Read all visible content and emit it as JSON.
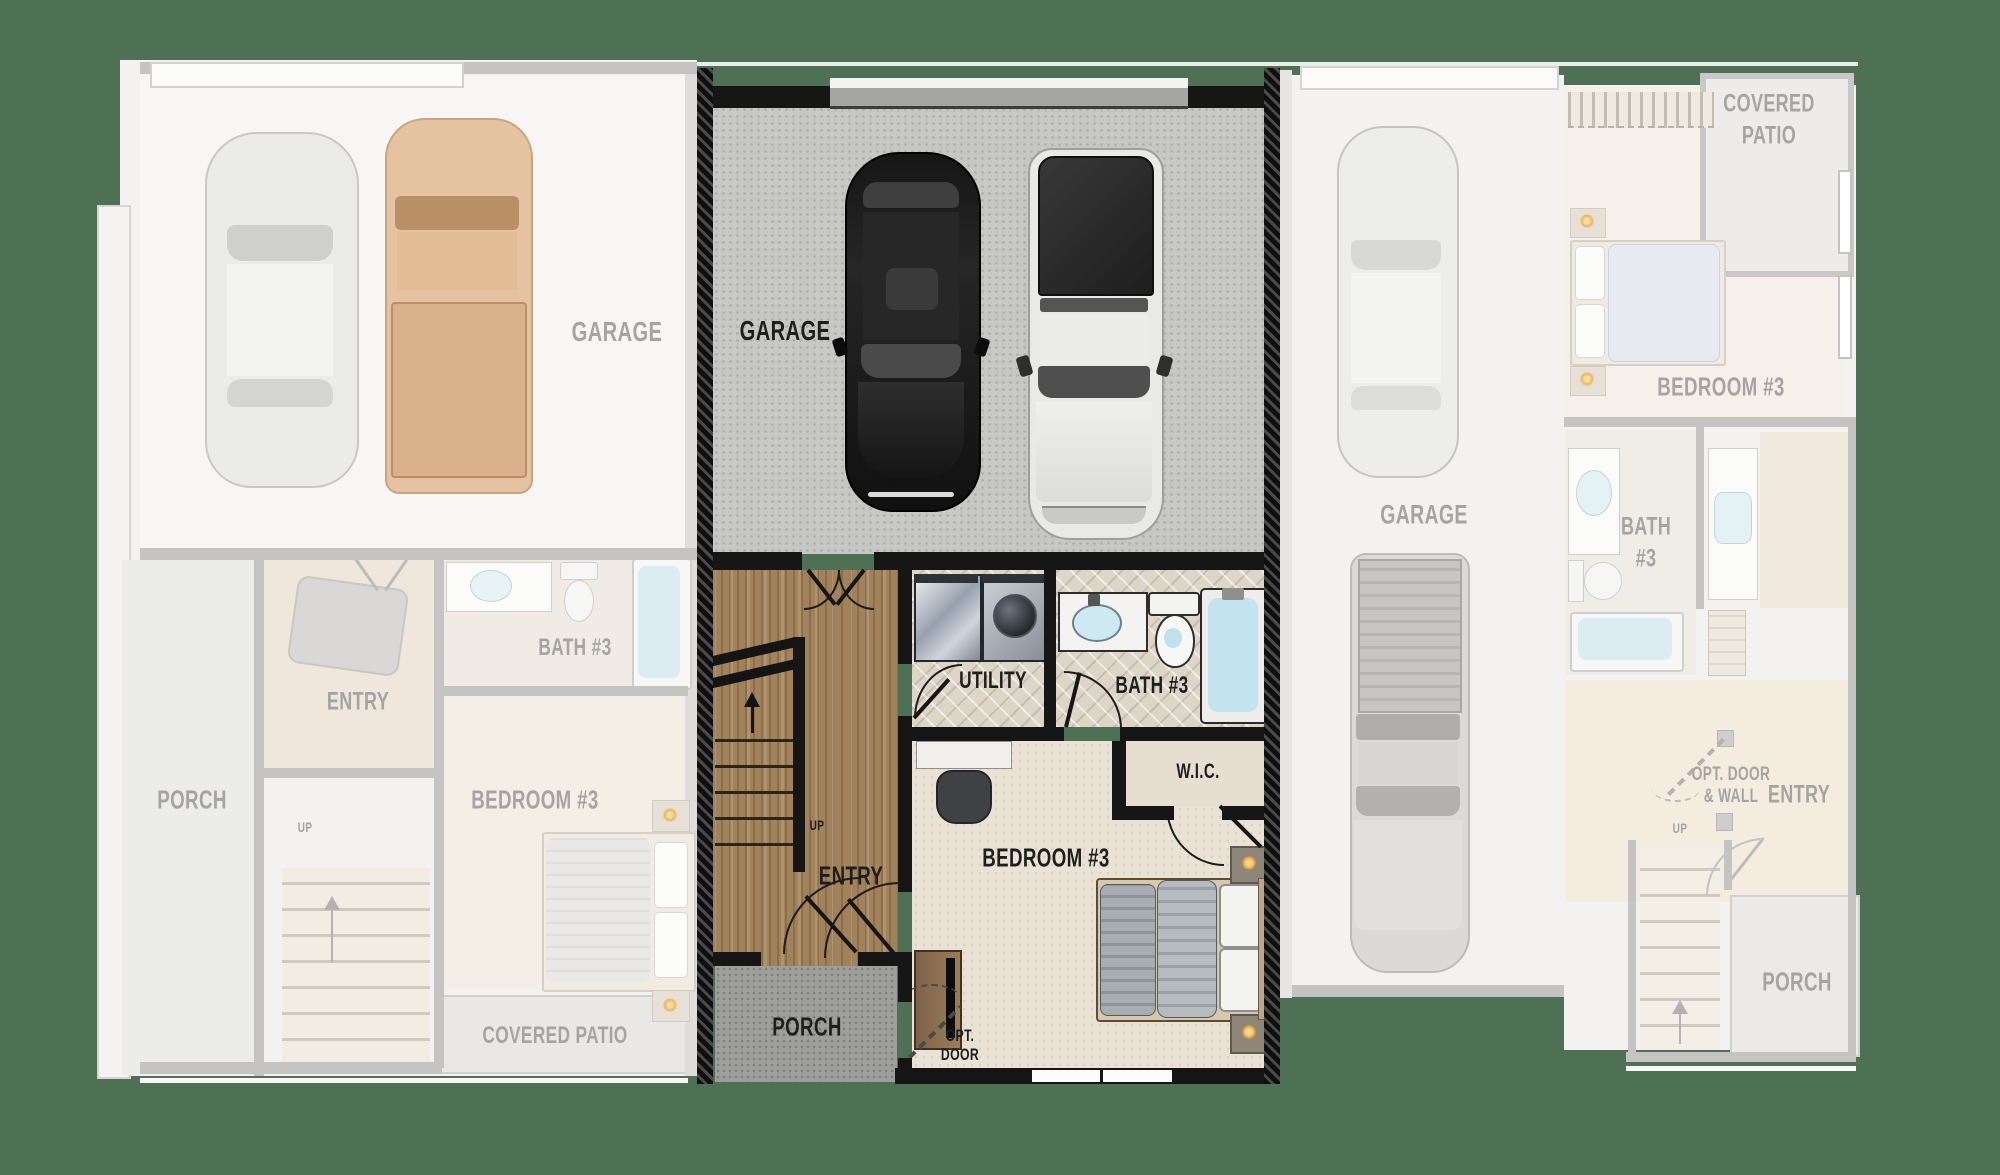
{
  "title": "Townhome floor plan — main level, middle unit highlighted",
  "colors": {
    "background": "#4e7155",
    "active_wall": "#161616",
    "inactive_wall": "#c5c4c2",
    "wood_floor": "#a2825a",
    "concrete_floor": "#c7c7c5",
    "tile_floor": "#ddd6c7",
    "tub_water": "#c3e4ee",
    "lamp_glow": "#eba93d"
  },
  "units": {
    "left": {
      "state": "inactive",
      "labels": {
        "garage": "GARAGE",
        "bath": "BATH #3",
        "entry": "ENTRY",
        "porch": "PORCH",
        "bedroom": "BEDROOM #3",
        "up": "UP",
        "covered_patio": "COVERED PATIO"
      }
    },
    "center": {
      "state": "active",
      "labels": {
        "garage": "GARAGE",
        "utility": "UTILITY",
        "bath": "BATH #3",
        "wic": "W.I.C.",
        "entry": "ENTRY",
        "up": "UP",
        "bedroom": "BEDROOM #3",
        "porch": "PORCH",
        "opt_door_line1": "OPT.",
        "opt_door_line2": "DOOR"
      }
    },
    "right": {
      "state": "inactive",
      "labels": {
        "covered_patio_line1": "COVERED",
        "covered_patio_line2": "PATIO",
        "bedroom": "BEDROOM #3",
        "garage": "GARAGE",
        "bath_line1": "BATH",
        "bath_line2": "#3",
        "opt_door_line1": "OPT. DOOR",
        "opt_door_line2": "& WALL",
        "entry": "ENTRY",
        "up": "UP",
        "porch": "PORCH"
      }
    }
  }
}
